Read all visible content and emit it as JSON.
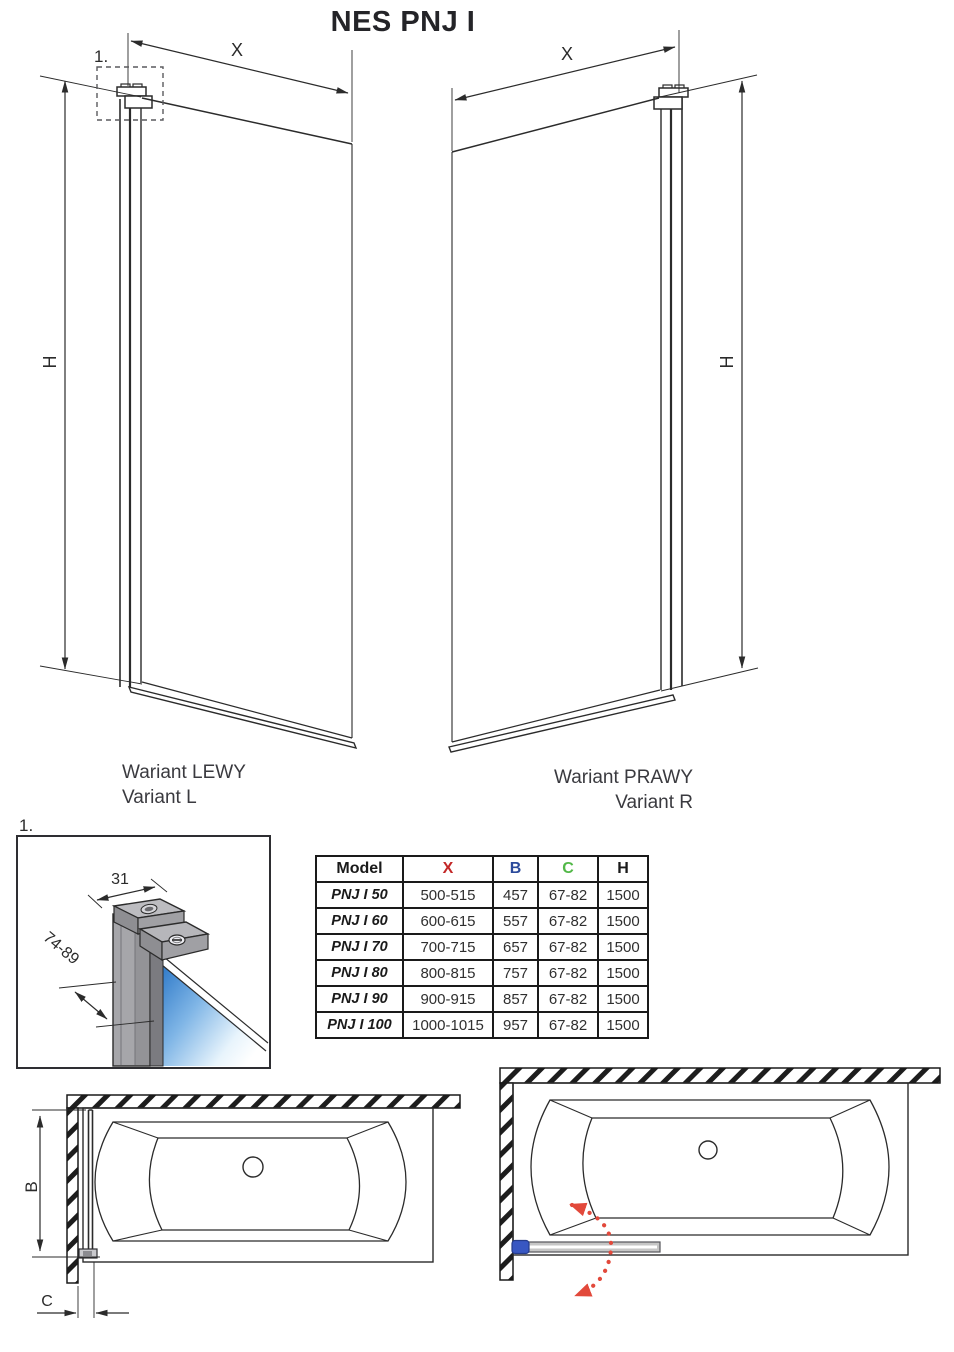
{
  "title": "NES PNJ I",
  "detail_ref": "1.",
  "dimensions": {
    "x": "X",
    "h": "H",
    "b": "B",
    "c": "C",
    "profile_width": "31",
    "profile_adjust_range": "74-89"
  },
  "variants": {
    "left": {
      "label_pl": "Wariant LEWY",
      "label_en": "Variant L"
    },
    "right": {
      "label_pl": "Wariant PRAWY",
      "label_en": "Variant R"
    }
  },
  "table": {
    "headers": [
      "Model",
      "X",
      "B",
      "C",
      "H"
    ],
    "rows": [
      {
        "model": "PNJ I 50",
        "x": "500-515",
        "b": "457",
        "c": "67-82",
        "h": "1500"
      },
      {
        "model": "PNJ I 60",
        "x": "600-615",
        "b": "557",
        "c": "67-82",
        "h": "1500"
      },
      {
        "model": "PNJ I 70",
        "x": "700-715",
        "b": "657",
        "c": "67-82",
        "h": "1500"
      },
      {
        "model": "PNJ I 80",
        "x": "800-815",
        "b": "757",
        "c": "67-82",
        "h": "1500"
      },
      {
        "model": "PNJ I 90",
        "x": "900-915",
        "b": "857",
        "c": "67-82",
        "h": "1500"
      },
      {
        "model": "PNJ I 100",
        "x": "1000-1015",
        "b": "957",
        "c": "67-82",
        "h": "1500"
      }
    ]
  },
  "colors": {
    "dim_x_red": "#c32727",
    "col_b_blue": "#2b4a9b",
    "col_c_green": "#52b848",
    "swing_arrow_red": "#e2493b",
    "glass_blue": "#2e79c8",
    "hinge_blue": "#3857c2",
    "line": "#2b2b2b"
  }
}
